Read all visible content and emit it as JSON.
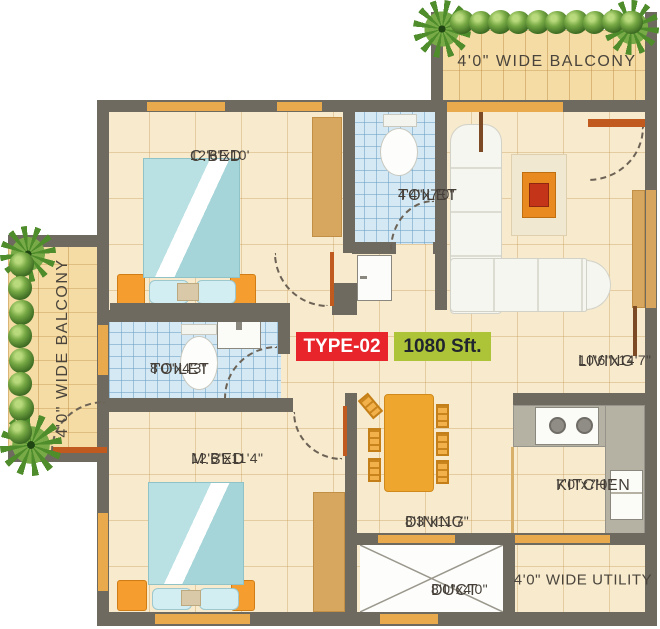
{
  "badges": {
    "type": "TYPE-02",
    "area": "1080 Sft."
  },
  "rooms": {
    "cbed": {
      "name": "C.BED",
      "dims": "12'6\"x10'"
    },
    "toilet_top": {
      "name": "TOILET",
      "dims": "4'4\"x7'0\""
    },
    "living": {
      "name": "LIVING",
      "dims": "10'6\"x14'7\""
    },
    "toilet_left": {
      "name": "TOILET",
      "dims": "8'0\"x4'3\""
    },
    "mbed": {
      "name": "M.BED",
      "dims": "12'6\"x11'4\""
    },
    "dining": {
      "name": "DINING",
      "dims": "8'3\"x11'7\""
    },
    "kitchen": {
      "name": "KITCHEN",
      "dims": "7'0\"x7'0\""
    },
    "duct": {
      "name": "DUCT",
      "dims": "8'0\"x4'0\""
    }
  },
  "balconies": {
    "top": "4'0\" WIDE BALCONY",
    "left": "4'0\" WIDE BALCONY"
  },
  "utility": {
    "label": "4'0\" WIDE UTILITY"
  },
  "colors": {
    "wall": "#6f6a60",
    "floor": "#f7eacd",
    "balcony_floor": "#f4dca4",
    "toilet_tile": "#d4e9f4",
    "window_orange": "#e9a94d",
    "badge_red": "#e8252b",
    "badge_green": "#adc338",
    "furniture_orange": "#f59d2e",
    "bed_teal": "#aedade"
  }
}
